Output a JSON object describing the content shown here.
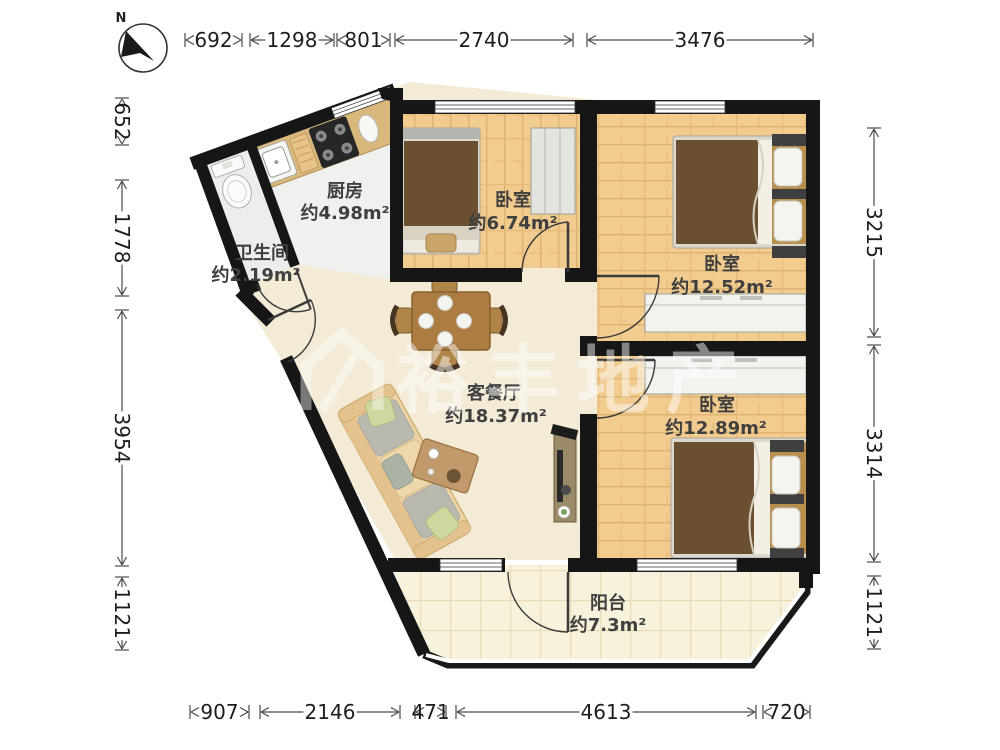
{
  "compass": {
    "label": "N"
  },
  "rooms": {
    "kitchen": {
      "name": "厨房",
      "area": "约4.98m²"
    },
    "bathroom": {
      "name": "卫生间",
      "area": "约2.19m²"
    },
    "bedroom_top": {
      "name": "卧室",
      "area": "约6.74m²"
    },
    "bedroom_right": {
      "name": "卧室",
      "area": "约12.52m²"
    },
    "bedroom_bottom": {
      "name": "卧室",
      "area": "约12.89m²"
    },
    "living": {
      "name": "客餐厅",
      "area": "约18.37m²"
    },
    "balcony": {
      "name": "阳台",
      "area": "约7.3m²"
    }
  },
  "dimensions": {
    "top": [
      "692",
      "1298",
      "801",
      "2740",
      "3476"
    ],
    "bottom": [
      "907",
      "2146",
      "471",
      "4613",
      "720"
    ],
    "left": [
      "652",
      "1778",
      "3954",
      "1121"
    ],
    "right": [
      "3215",
      "3314",
      "1121"
    ]
  },
  "watermark": {
    "text": "裕丰地产"
  },
  "colors": {
    "wall": "#161616",
    "wood_floor": "#f1cc8e",
    "living_floor": "#f3ebd6",
    "balcony_floor": "#f8f1dc",
    "tile_floor": "#eceeed",
    "counter": "#d9b87c",
    "blanket": "#6a5031",
    "label": "#3f3f3f"
  }
}
